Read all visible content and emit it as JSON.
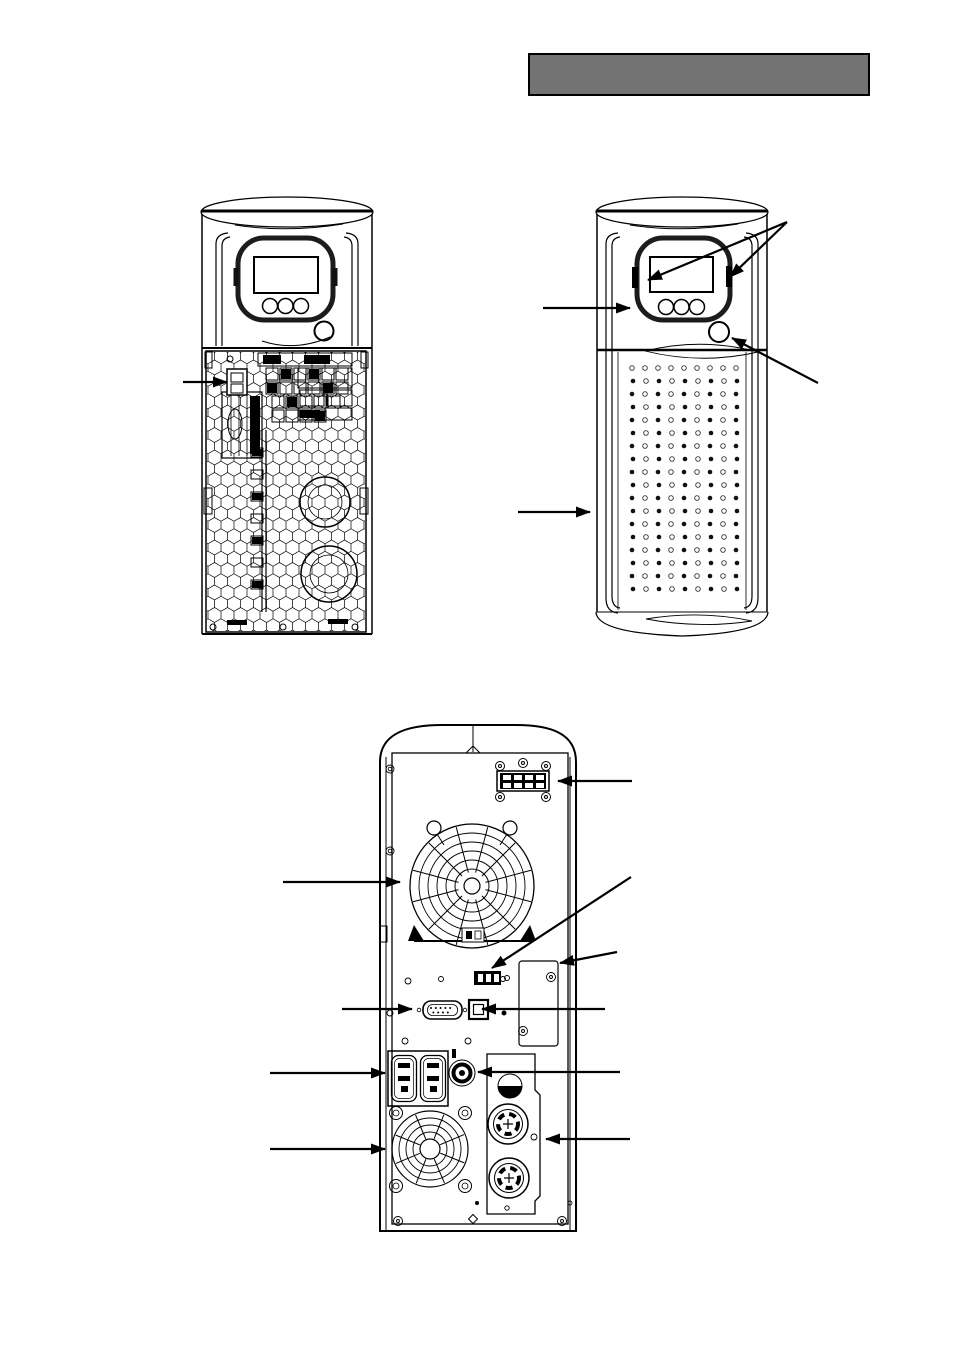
{
  "page": {
    "width": 954,
    "height": 1349,
    "background": "#ffffff"
  },
  "header_bar": {
    "label": "",
    "fill": "#737373",
    "border_color": "#000000"
  },
  "line_color": "#000000",
  "figures": {
    "front_open": {
      "name": "ups-front-view-cover-removed",
      "components": [
        "lcd-display",
        "control-buttons",
        "power-button",
        "battery-connector",
        "honeycomb-grille",
        "internal-chassis"
      ]
    },
    "front_closed": {
      "name": "ups-front-view-with-cover",
      "components": [
        "lcd-display",
        "control-buttons",
        "power-button",
        "panel-latch-left",
        "panel-latch-right",
        "front-cover",
        "ventilation-perforations"
      ],
      "perforation": {
        "columns": 9,
        "rows": 18
      }
    },
    "rear": {
      "name": "ups-rear-view",
      "components": [
        "input-terminal-block",
        "cooling-fan-upper",
        "maintenance-connector",
        "option-slot",
        "serial-port",
        "usb-port",
        "output-receptacles",
        "circuit-breaker",
        "cooling-fan-lower",
        "output-connector-panel",
        "output-connector-1",
        "output-connector-2"
      ]
    }
  },
  "callouts": [
    {
      "id": "callout-battery-connector",
      "target": "battery-connector",
      "from": [
        183,
        382
      ],
      "to": [
        227,
        382
      ]
    },
    {
      "id": "callout-panel-latch-left",
      "target": "panel-latch-left",
      "from": [
        787,
        222
      ],
      "to": [
        648,
        280
      ]
    },
    {
      "id": "callout-panel-latch-right",
      "target": "panel-latch-right",
      "from": [
        787,
        222
      ],
      "to": [
        730,
        277
      ]
    },
    {
      "id": "callout-control-panel",
      "target": "control-panel",
      "from": [
        543,
        308
      ],
      "to": [
        630,
        308
      ]
    },
    {
      "id": "callout-power-button",
      "target": "power-button",
      "from": [
        818,
        383
      ],
      "to": [
        732,
        338
      ]
    },
    {
      "id": "callout-front-cover",
      "target": "front-cover",
      "from": [
        518,
        512
      ],
      "to": [
        590,
        512
      ]
    },
    {
      "id": "callout-input-terminal-block",
      "target": "input-terminal-block",
      "from": [
        632,
        781
      ],
      "to": [
        558,
        781
      ]
    },
    {
      "id": "callout-maintenance-connector",
      "target": "maintenance-connector",
      "from": [
        631,
        877
      ],
      "to": [
        492,
        968
      ]
    },
    {
      "id": "callout-cooling-fan-upper",
      "target": "cooling-fan-upper",
      "from": [
        283,
        882
      ],
      "to": [
        400,
        882
      ]
    },
    {
      "id": "callout-option-slot",
      "target": "option-slot",
      "from": [
        617,
        952
      ],
      "to": [
        560,
        963
      ]
    },
    {
      "id": "callout-serial-port",
      "target": "serial-port",
      "from": [
        342,
        1009
      ],
      "to": [
        412,
        1009
      ]
    },
    {
      "id": "callout-usb-port",
      "target": "usb-port",
      "from": [
        605,
        1009
      ],
      "to": [
        482,
        1009
      ]
    },
    {
      "id": "callout-output-receptacles",
      "target": "output-receptacles",
      "from": [
        270,
        1073
      ],
      "to": [
        385,
        1073
      ]
    },
    {
      "id": "callout-circuit-breaker",
      "target": "circuit-breaker",
      "from": [
        620,
        1072
      ],
      "to": [
        478,
        1072
      ]
    },
    {
      "id": "callout-cooling-fan-lower",
      "target": "cooling-fan-lower",
      "from": [
        270,
        1149
      ],
      "to": [
        385,
        1149
      ]
    },
    {
      "id": "callout-output-connector-panel",
      "target": "output-connector-panel",
      "from": [
        630,
        1139
      ],
      "to": [
        546,
        1139
      ]
    }
  ]
}
